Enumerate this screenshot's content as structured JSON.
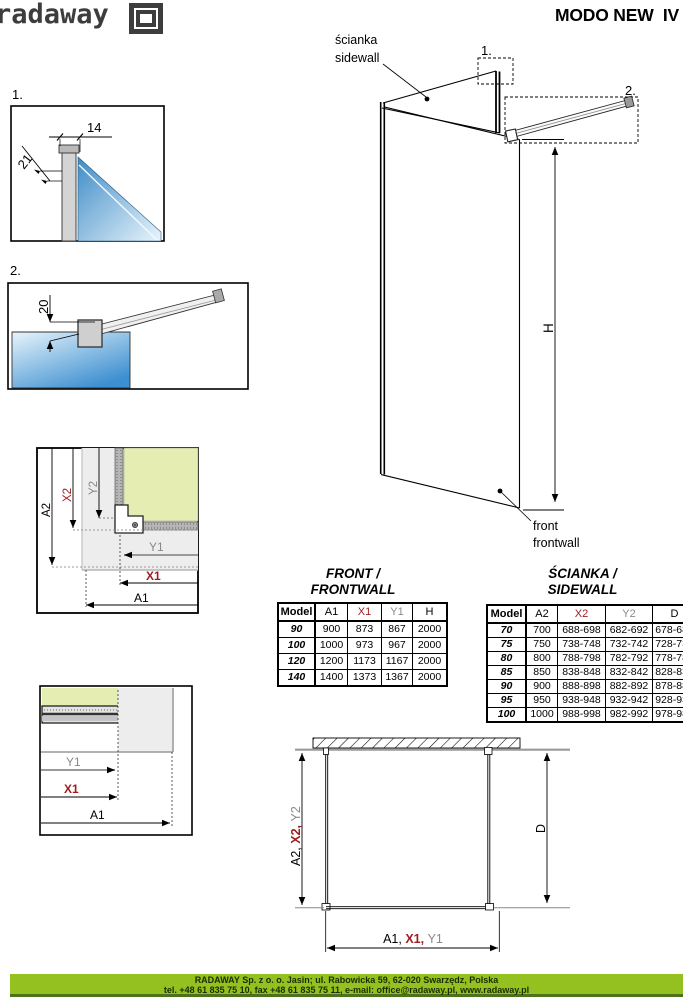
{
  "header": {
    "logo_text": "radaway",
    "title": "MODO NEW  IV"
  },
  "iso": {
    "ref1": "1.",
    "ref2": "2.",
    "sidewall_label_pl": "ścianka",
    "sidewall_label_en": "sidewall",
    "frontwall_label_en1": "front",
    "frontwall_label_en2": "frontwall",
    "height_label": "H"
  },
  "detail1": {
    "ref": "1.",
    "width_dim": "14",
    "glass_dim": "21"
  },
  "detail2": {
    "ref": "2.",
    "offset_dim": "20"
  },
  "corner_detail": {
    "a2": "A2",
    "x2": "X2",
    "y2": "Y2",
    "y1": "Y1",
    "x1": "X1",
    "a1": "A1"
  },
  "profile_detail": {
    "y1": "Y1",
    "x1": "X1",
    "a1": "A1"
  },
  "plan": {
    "side_a2": "A2, ",
    "side_x2": "X2, ",
    "side_y2": "Y2",
    "depth_label": "D",
    "front_a1": "A1, ",
    "front_x1": "X1, ",
    "front_y1": "Y1"
  },
  "front_table": {
    "title_l1": "FRONT /",
    "title_l2": "FRONTWALL",
    "headers": [
      "Model",
      "A1",
      "X1",
      "Y1",
      "H"
    ],
    "rows": [
      [
        "90",
        "900",
        "873",
        "867",
        "2000"
      ],
      [
        "100",
        "1000",
        "973",
        "967",
        "2000"
      ],
      [
        "120",
        "1200",
        "1173",
        "1167",
        "2000"
      ],
      [
        "140",
        "1400",
        "1373",
        "1367",
        "2000"
      ]
    ]
  },
  "side_table": {
    "title_l1": "ŚCIANKA /",
    "title_l2": "SIDEWALL",
    "headers": [
      "Model",
      "A2",
      "X2",
      "Y2",
      "D"
    ],
    "rows": [
      [
        "70",
        "700",
        "688-698",
        "682-692",
        "678-688"
      ],
      [
        "75",
        "750",
        "738-748",
        "732-742",
        "728-738"
      ],
      [
        "80",
        "800",
        "788-798",
        "782-792",
        "778-788"
      ],
      [
        "85",
        "850",
        "838-848",
        "832-842",
        "828-838"
      ],
      [
        "90",
        "900",
        "888-898",
        "882-892",
        "878-888"
      ],
      [
        "95",
        "950",
        "938-948",
        "932-942",
        "928-938"
      ],
      [
        "100",
        "1000",
        "988-998",
        "982-992",
        "978-988"
      ]
    ]
  },
  "footer": {
    "line1": "RADAWAY Sp. z o. o. Jasin; ul. Rabowicka 59, 62-020 Swarzędz, Polska",
    "line2": "tel. +48 61 835 75 10, fax +48 61 835 75 11, e-mail: office@radaway.pl, www.radaway.pl"
  },
  "colors": {
    "accent_red": "#9e1b1e",
    "dim_gray": "#8a8a8a",
    "footer_green": "#94c11f",
    "footer_green_dark": "#4c721b",
    "glass_blue": "#2e86c8",
    "glass_green_top": "#e5edb3",
    "logo_gray": "#3d3d3d"
  }
}
